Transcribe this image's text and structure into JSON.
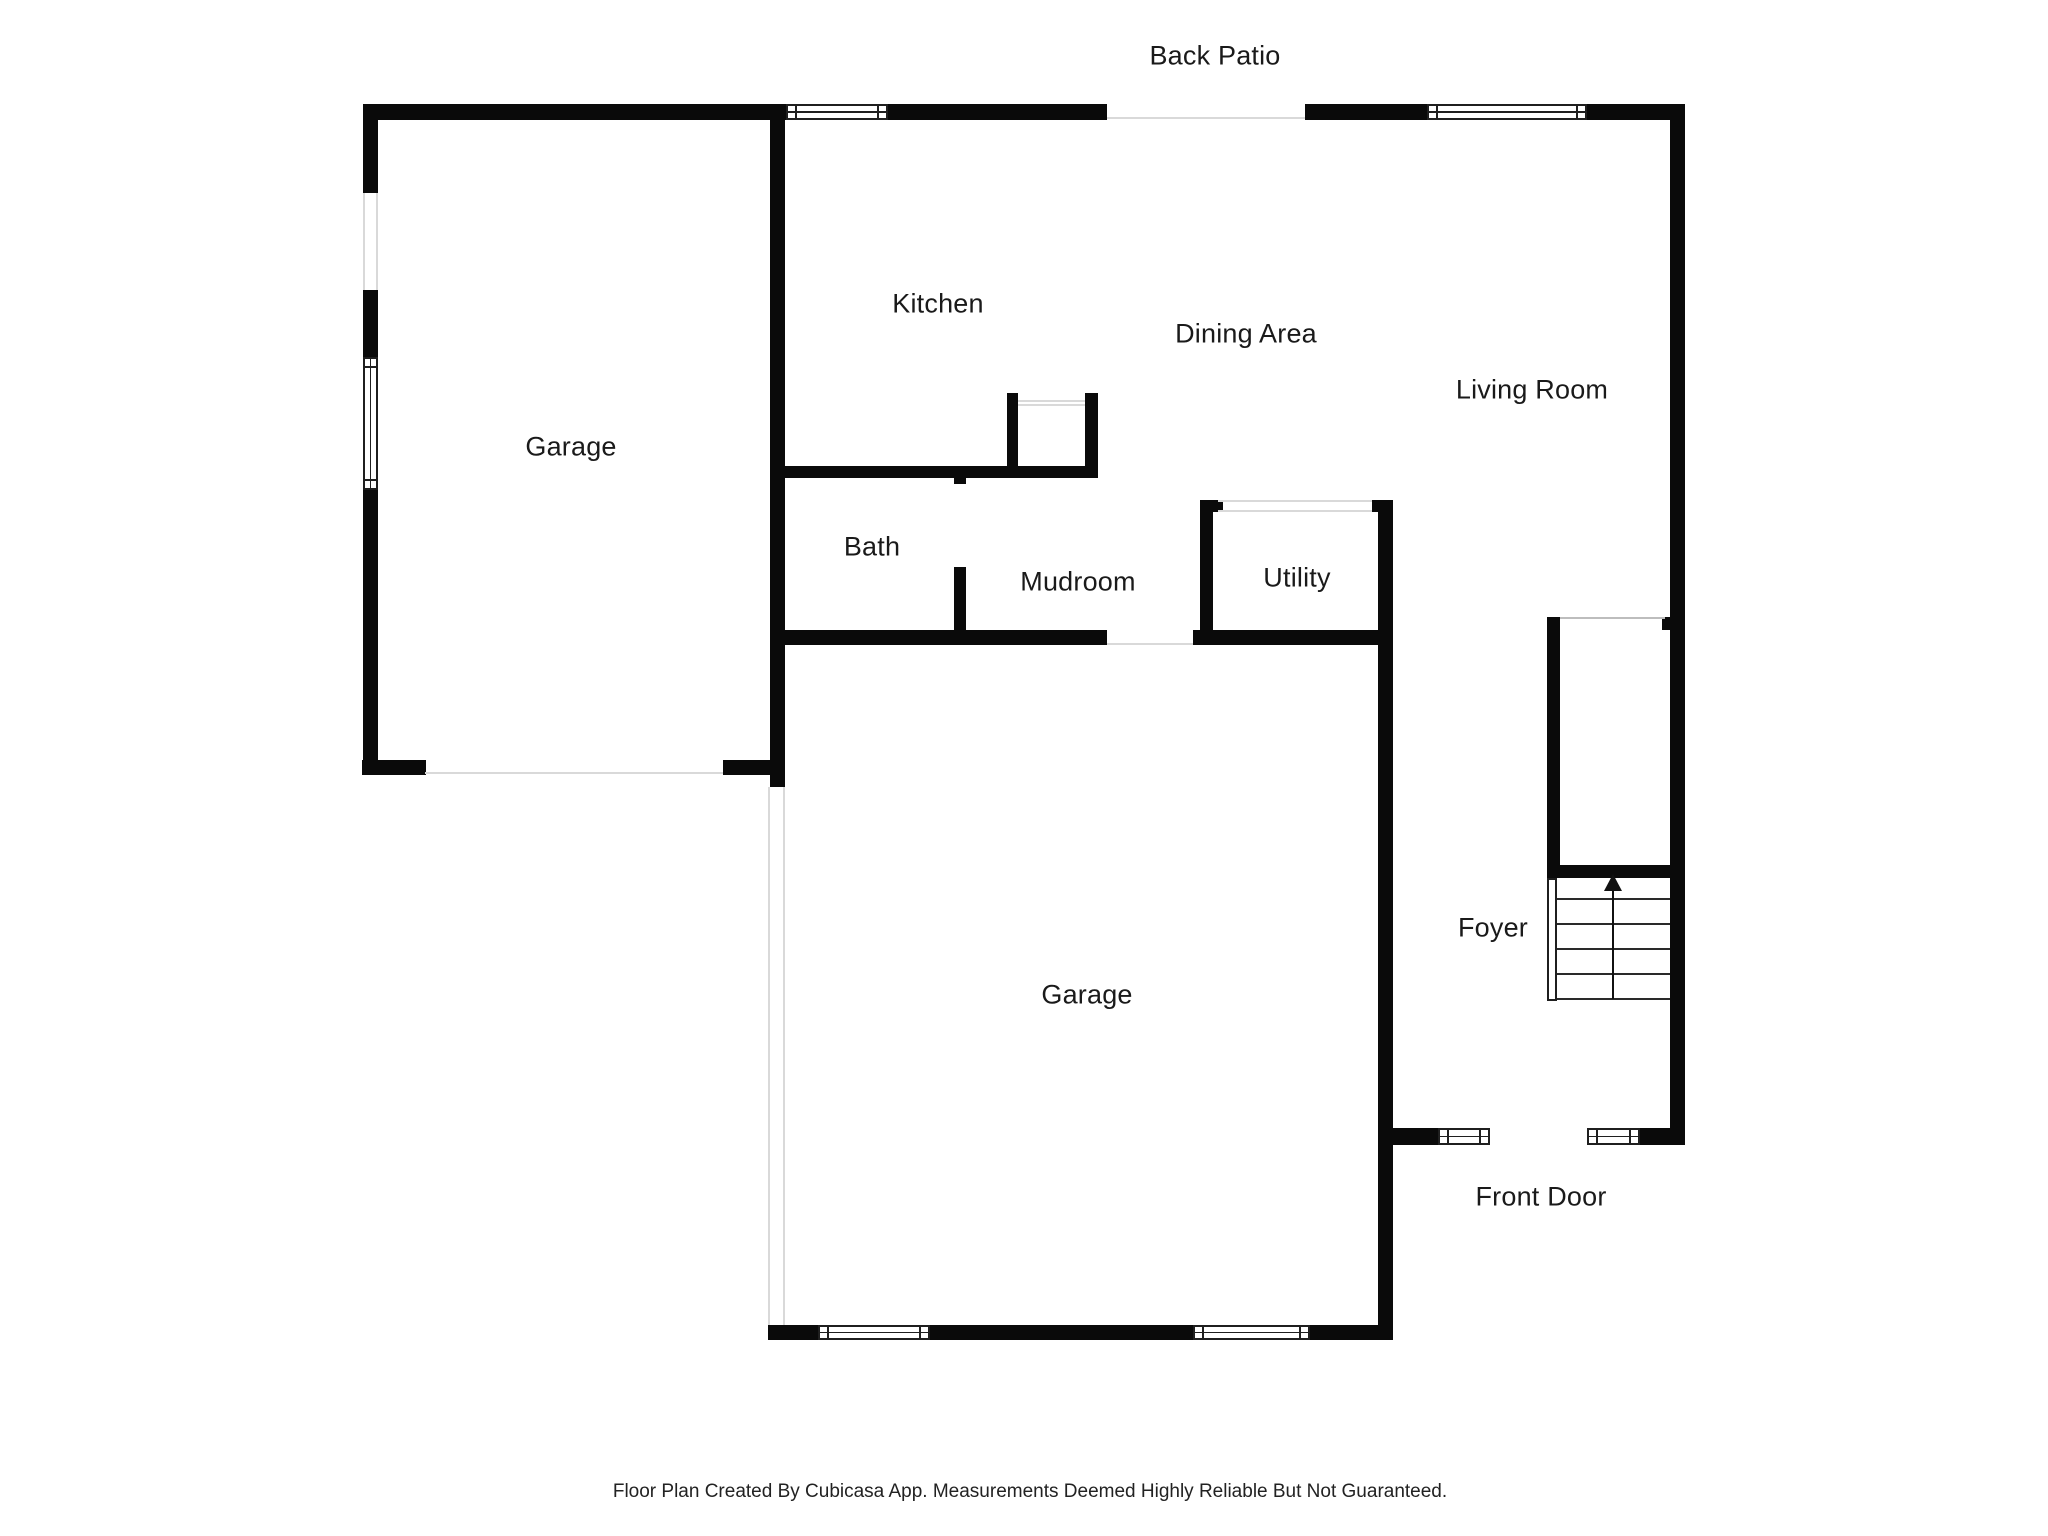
{
  "labels": {
    "back_patio": "Back Patio",
    "garage_top": "Garage",
    "kitchen": "Kitchen",
    "dining_area": "Dining Area",
    "living_room": "Living Room",
    "bath": "Bath",
    "mudroom": "Mudroom",
    "utility": "Utility",
    "garage_bottom": "Garage",
    "foyer": "Foyer",
    "front_door": "Front Door"
  },
  "footer": {
    "disclaimer": "Floor Plan Created By Cubicasa App. Measurements Deemed Highly Reliable But Not Guaranteed."
  },
  "icons": {
    "stairs_direction": "up-arrow"
  },
  "colors": {
    "background": "#ffffff",
    "wall": "#0a0a0a",
    "window_frame": "#1f1f1f",
    "opening_threshold": "#d9d9d9",
    "stair_tread": "#2a2a2a",
    "label_text": "#1a1a1a"
  }
}
